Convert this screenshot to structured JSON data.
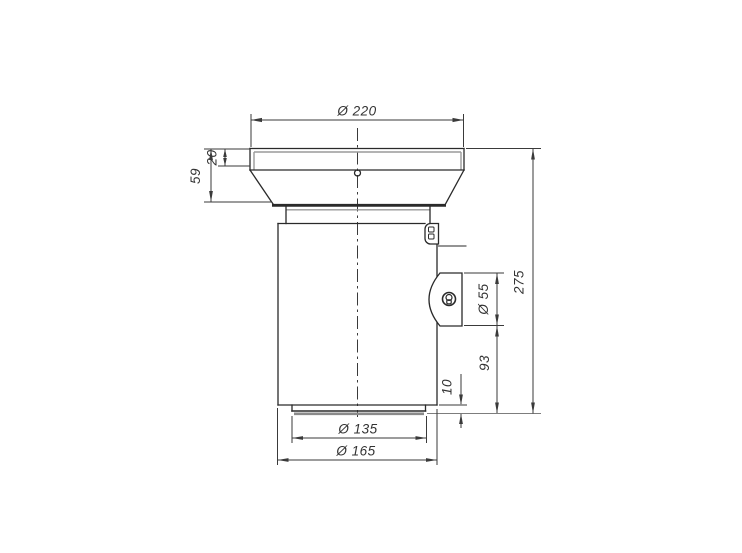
{
  "drawing": {
    "type": "technical-dimension-drawing",
    "dimensions": {
      "top_diameter": "Ø 220",
      "rim_height": "20",
      "funnel_height": "59",
      "outlet_diameter": "Ø 55",
      "overall_height": "275",
      "outlet_bottom_offset": "93",
      "lip_height": "10",
      "lip_diameter": "Ø 135",
      "body_diameter": "Ø 165"
    },
    "colors": {
      "line": "#2a2a2a",
      "gray": "#9a9a9a",
      "dim": "#3a3a3a",
      "text": "#333333",
      "background": "#ffffff"
    }
  }
}
